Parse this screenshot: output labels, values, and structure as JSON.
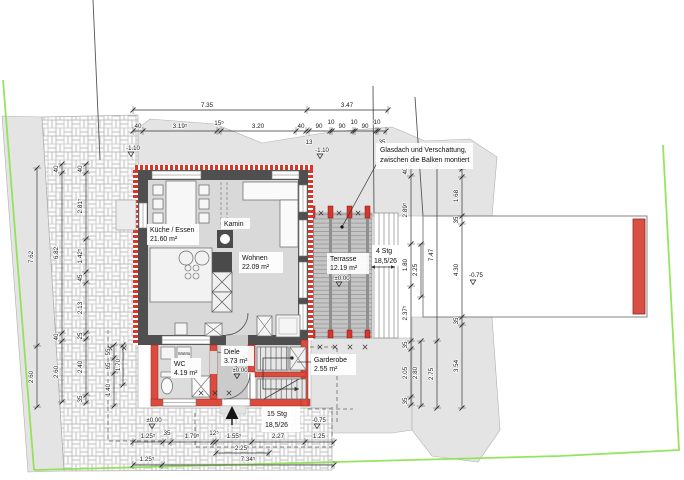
{
  "meta": {
    "drawing_type": "Grundriss Erdgeschoss (architectural site / floor plan)",
    "language": "de"
  },
  "colors": {
    "wall_existing": "#4f4f4f",
    "wall_new_masonry": "#dd4b3e",
    "insulation_red": "#d8352b",
    "terrain_gray": "#e4e4e4",
    "boundary_green": "#8ce14f",
    "garden_wall_red": "#d94f43"
  },
  "rooms": {
    "kueche": {
      "name": "Küche / Essen",
      "area": "21.60 m²"
    },
    "wohnen": {
      "name": "Wohnen",
      "area": "22.09 m²"
    },
    "terrasse": {
      "name": "Terrasse",
      "area": "12.19 m²",
      "level": "±0.00"
    },
    "diele": {
      "name": "Diele",
      "area": "3.73 m²",
      "level": "±0.00"
    },
    "wc": {
      "name": "WC",
      "area": "4.19 m²"
    },
    "garderobe": {
      "name": "Garderobe",
      "area": "2.55 m²"
    }
  },
  "annotations": {
    "kamin": "Kamin",
    "wama": "WaMa",
    "glass_roof_1": "Glasdach und Verschattung,",
    "glass_roof_2": "zwischen die Balken montiert",
    "outdoor_stairs_1": "4 Stg",
    "outdoor_stairs_2": "18,5/26",
    "indoor_stairs_1": "15 Stg",
    "indoor_stairs_2": "18,5/26"
  },
  "levels": {
    "entry_outside": "±0.00",
    "entry_street": "-0.75",
    "garden": "-0.75",
    "site_left": "-1.10",
    "site_center": "-1.10"
  },
  "dimensions": {
    "top_total": [
      "7.35",
      "3.47"
    ],
    "top_detail": [
      "40",
      "3.19⁵",
      "15⁵",
      "3.20",
      "40",
      "90",
      "10",
      "90",
      "10",
      "90",
      "10"
    ],
    "top_below": [
      "13",
      "35"
    ],
    "left_outer": [
      "7.62",
      "2.60"
    ],
    "left_mid": [
      "40",
      "6.82",
      "40",
      "2.60"
    ],
    "left_inner": [
      "40",
      "2.81⁵",
      "1.42⁵",
      "45",
      "2.13",
      "25",
      "2.40",
      "35"
    ],
    "left_house": [
      "55",
      "65",
      "1.40",
      "1.70"
    ],
    "right_inner": [
      "40",
      "2.89⁵",
      "1.80",
      "2.37⁵",
      "35",
      "2.05",
      "35"
    ],
    "right_secondary": [
      "2.25",
      "2.80"
    ],
    "right_mid": [
      "7.47",
      "2.75"
    ],
    "right_outer": [
      "1.68",
      "35",
      "4.30",
      "35",
      "3.54"
    ],
    "wall_thickness": "40",
    "bottom_detail": [
      "1.25⁵",
      "35",
      "1.79⁵",
      "12⁵",
      "1.55⁵",
      "2.27",
      "1.25"
    ],
    "bottom_mid": "2.25",
    "bottom_total": [
      "1.25⁵",
      "7.34⁵"
    ]
  }
}
